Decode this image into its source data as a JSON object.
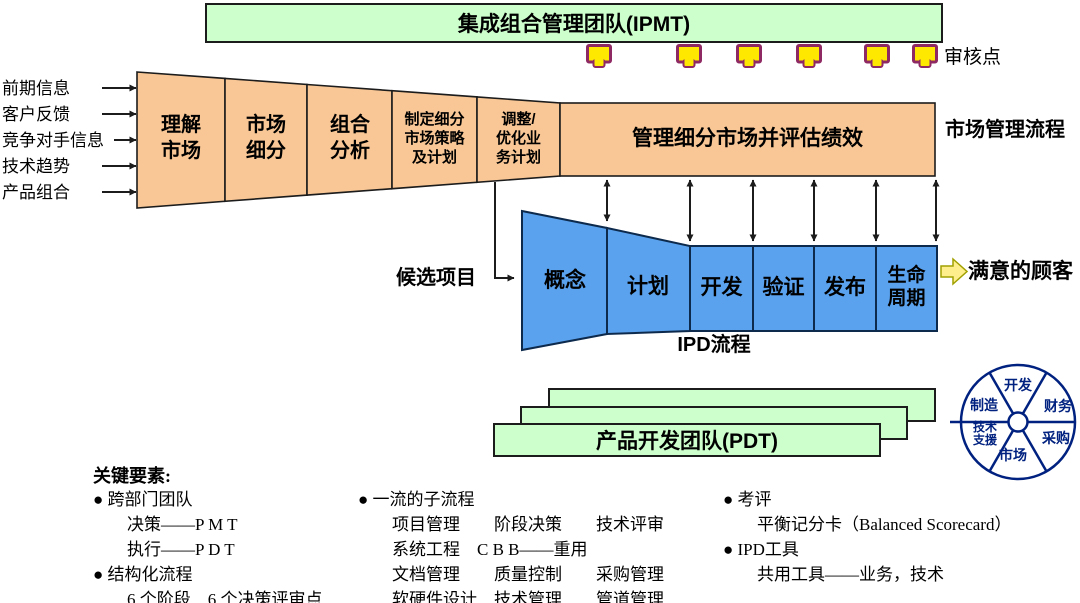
{
  "colors": {
    "team_green": "#ccffcc",
    "market_orange": "#f9c795",
    "ipd_blue": "#5aa2ee",
    "review_point_yellow": "#ffe800",
    "review_point_border": "#8e2963",
    "customer_arrow_yellow": "#ffee8c",
    "wheel_navy": "#00217f",
    "outline_black": "#1c1c1c"
  },
  "ipmt_bar": {
    "label": "集成组合管理团队(IPMT)"
  },
  "review_points": {
    "label": "审核点",
    "count": 6
  },
  "inputs": {
    "lines": [
      "前期信息",
      "客户反馈",
      "竞争对手信息",
      "技术趋势",
      "产品组合"
    ]
  },
  "market_funnel": {
    "segments": [
      {
        "label": "理解\n市场"
      },
      {
        "label": "市场\n细分"
      },
      {
        "label": "组合\n分析"
      },
      {
        "label": "制定细分\n市场策略\n及计划"
      },
      {
        "label": "调整/\n优化业\n务计划"
      }
    ],
    "manage_label": "管理细分市场并评估绩效"
  },
  "market_process_label": "市场管理流程",
  "candidate_label": "候选项目",
  "ipd_funnel": {
    "phases": [
      {
        "label": "概念"
      },
      {
        "label": "计划"
      },
      {
        "label": "开发"
      },
      {
        "label": "验证"
      },
      {
        "label": "发布"
      },
      {
        "label": "生命\n周期"
      }
    ]
  },
  "ipd_process_label": "IPD流程",
  "satisfied_customer_label": "满意的顾客",
  "pdt": {
    "label": "产品开发团队(PDT)"
  },
  "wheel": {
    "sectors": [
      {
        "label": "开发"
      },
      {
        "label": "财务"
      },
      {
        "label": "采购"
      },
      {
        "label": "市场"
      },
      {
        "label": "技术\n支援"
      },
      {
        "label": "制造"
      }
    ]
  },
  "key_elements": {
    "heading": "关键要素:",
    "col1": {
      "lines": [
        "● 跨部门团队",
        "　　决策——P M T",
        "　　执行——P D T",
        "● 结构化流程",
        "　　6 个阶段　6 个决策评审点"
      ]
    },
    "col2": {
      "lines": [
        "● 一流的子流程",
        "　　项目管理　　阶段决策　　技术评审",
        "　　系统工程　C B B——重用",
        "　　文档管理　　质量控制　　采购管理",
        "　　软硬件设计　技术管理　　管道管理"
      ]
    },
    "col3": {
      "lines": [
        "● 考评",
        "　　平衡记分卡（Balanced Scorecard）",
        "● IPD工具",
        "　　共用工具——业务，技术"
      ]
    }
  }
}
